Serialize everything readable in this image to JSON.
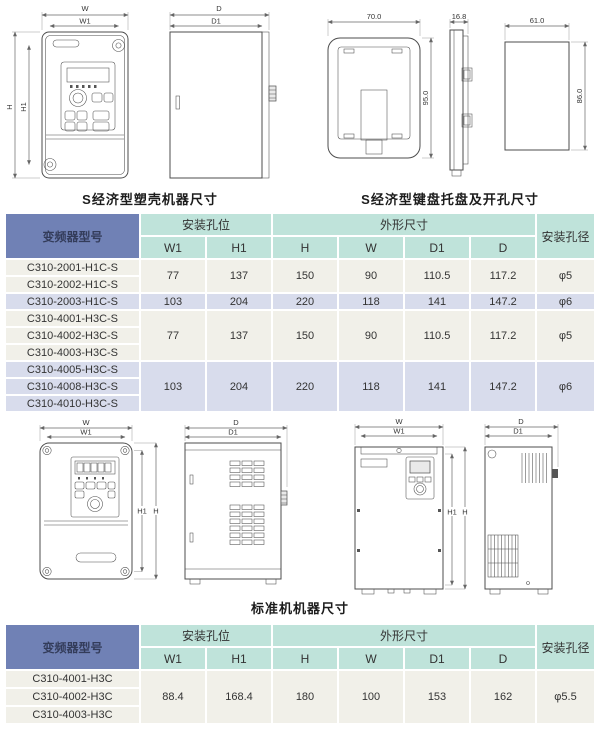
{
  "captions": {
    "s_machine": "S经济型塑壳机器尺寸",
    "s_keypad": "S经济型键盘托盘及开孔尺寸",
    "std_machine": "标准机机器尺寸"
  },
  "dims": {
    "w": "W",
    "w1": "W1",
    "h": "H",
    "h1": "H1",
    "d": "D",
    "d1": "D1",
    "tray_w": "70.0",
    "tray_h": "95.0",
    "tray_d": "16.8",
    "hole_w": "61.0",
    "hole_h": "86.0"
  },
  "colors": {
    "header_blue": "#7081b5",
    "header_teal": "#bfe3da",
    "row_cream": "#f1f0e9",
    "row_lavender": "#d8dcec"
  },
  "table_s": {
    "header": {
      "model": "变频器型号",
      "mount": "安装孔位",
      "outline": "外形尺寸",
      "hole": "安装孔径",
      "cols": [
        "W1",
        "H1",
        "H",
        "W",
        "D1",
        "D"
      ]
    },
    "rows": [
      {
        "model": "C310-2001-H1C-S"
      },
      {
        "model": "C310-2002-H1C-S"
      },
      {
        "model": "C310-2003-H1C-S"
      },
      {
        "model": "C310-4001-H3C-S"
      },
      {
        "model": "C310-4002-H3C-S"
      },
      {
        "model": "C310-4003-H3C-S"
      },
      {
        "model": "C310-4005-H3C-S"
      },
      {
        "model": "C310-4008-H3C-S"
      },
      {
        "model": "C310-4010-H3C-S"
      }
    ],
    "groups": [
      {
        "w1": "77",
        "h1": "137",
        "h": "150",
        "w": "90",
        "d1": "110.5",
        "d": "117.2",
        "dia": "φ5"
      },
      {
        "w1": "103",
        "h1": "204",
        "h": "220",
        "w": "118",
        "d1": "141",
        "d": "147.2",
        "dia": "φ6"
      },
      {
        "w1": "77",
        "h1": "137",
        "h": "150",
        "w": "90",
        "d1": "110.5",
        "d": "117.2",
        "dia": "φ5"
      },
      {
        "w1": "103",
        "h1": "204",
        "h": "220",
        "w": "118",
        "d1": "141",
        "d": "147.2",
        "dia": "φ6"
      }
    ]
  },
  "table_std": {
    "header": {
      "model": "变频器型号",
      "mount": "安装孔位",
      "outline": "外形尺寸",
      "hole": "安装孔径",
      "cols": [
        "W1",
        "H1",
        "H",
        "W",
        "D1",
        "D"
      ]
    },
    "rows": [
      {
        "model": "C310-4001-H3C"
      },
      {
        "model": "C310-4002-H3C"
      },
      {
        "model": "C310-4003-H3C"
      }
    ],
    "groups": [
      {
        "w1": "88.4",
        "h1": "168.4",
        "h": "180",
        "w": "100",
        "d1": "153",
        "d": "162",
        "dia": "φ5.5"
      }
    ]
  }
}
